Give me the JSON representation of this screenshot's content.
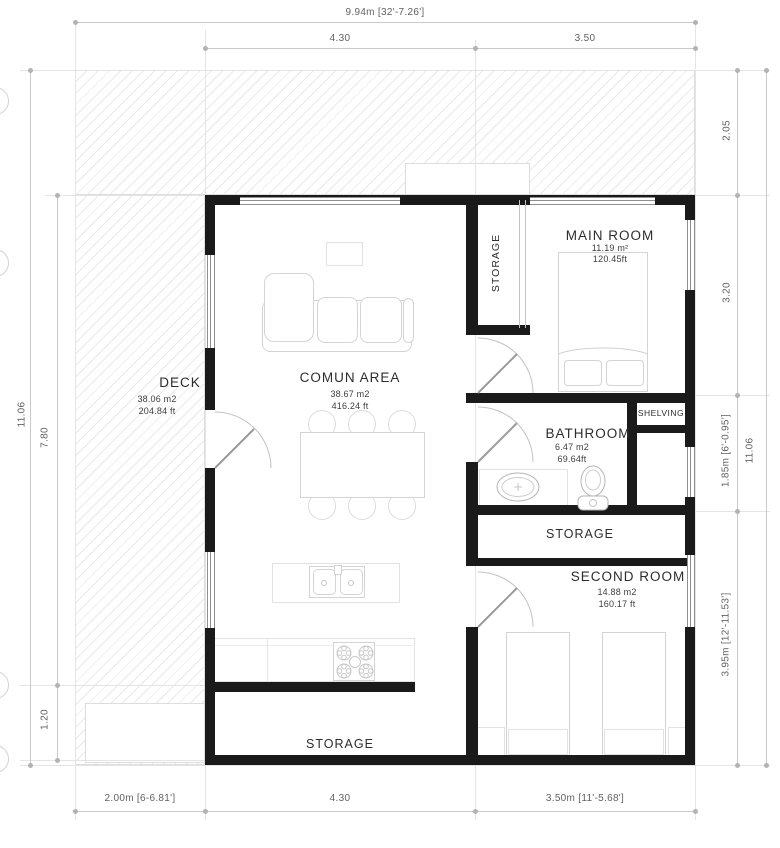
{
  "drawing": {
    "type": "floor-plan"
  },
  "rooms": {
    "deck": {
      "name": "DECK",
      "m2": "38.06 m2",
      "ft": "204.84 ft"
    },
    "comun": {
      "name": "COMUN AREA",
      "m2": "38.67 m2",
      "ft": "416.24 ft"
    },
    "storage_closet": {
      "name": "STORAGE"
    },
    "main": {
      "name": "MAIN ROOM",
      "m2": "11.19 m²",
      "ft": "120.45ft"
    },
    "bathroom": {
      "name": "BATHROOM",
      "m2": "6.47 m2",
      "ft": "69.64ft"
    },
    "shelving": {
      "name": "SHELVING"
    },
    "storage_mid": {
      "name": "STORAGE"
    },
    "second": {
      "name": "SECOND ROOM",
      "m2": "14.88 m2",
      "ft": "160.17 ft"
    },
    "storage_bottom": {
      "name": "STORAGE"
    }
  },
  "dims": {
    "top_total": "9.94m [32'-7.26']",
    "top_a": "4.30",
    "top_b": "3.50",
    "left_total": "11.06",
    "left_a": "7.80",
    "left_b": "1.20",
    "right_a": "2.05",
    "right_b": "3.20",
    "right_c": "1.85m [6'-0.95']",
    "right_d": "3.95m [12'-11.53']",
    "right_total": "11.06",
    "bottom_a": "2.00m [6-6.81']",
    "bottom_b": "4.30",
    "bottom_c": "3.50m [11'-5.68']"
  },
  "colors": {
    "wall": "#1a1a1a",
    "hatch": "#e9e9e9",
    "dim_text": "#616161",
    "furniture_line": "#d4d4d4"
  }
}
